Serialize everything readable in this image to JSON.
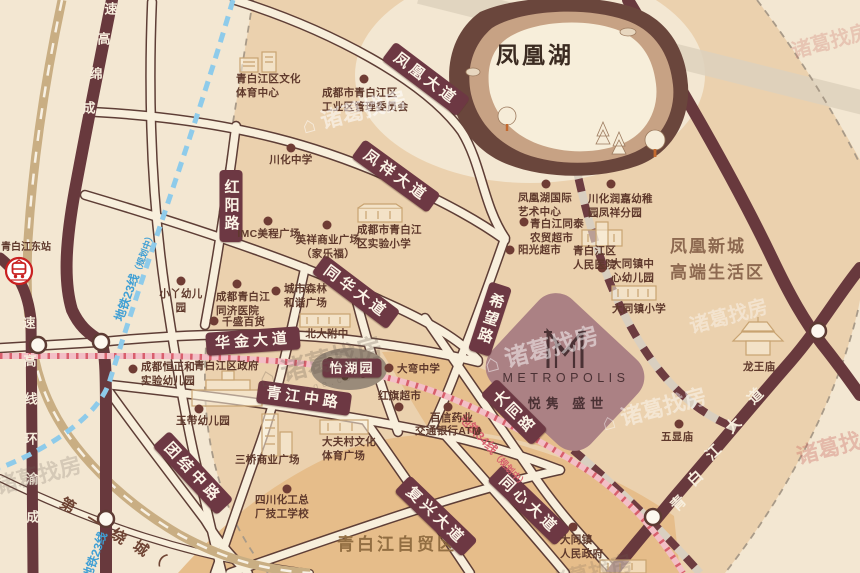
{
  "lake": {
    "label": "凤凰湖"
  },
  "areas": {
    "new_town": "凤凰新城\n高端生活区",
    "free_trade_zone": "青白江自贸区"
  },
  "station": {
    "label": "青白江东站"
  },
  "metropolis": {
    "name_en": "METROPOLIS",
    "name_cn": "悦隽 盛世"
  },
  "roads": {
    "pills": [
      {
        "label": "凤凰大道"
      },
      {
        "label": "凤祥大道"
      },
      {
        "label": "同华大道"
      },
      {
        "label": "红阳路"
      },
      {
        "label": "华金大道"
      },
      {
        "label": "青江中路"
      },
      {
        "label": "团结中路"
      },
      {
        "label": "希望路"
      },
      {
        "label": "大同路"
      },
      {
        "label": "复兴大道"
      },
      {
        "label": "同心大道"
      }
    ],
    "park_pill": "怡湖园",
    "chengmian": {
      "name": "成绵高速",
      "chars": [
        "速",
        "高",
        "绵",
        "成"
      ]
    },
    "chengyu": {
      "name": "成渝环线高速",
      "chars": [
        "速",
        "高",
        "线",
        "环",
        "渝",
        "成"
      ]
    },
    "qbj_avenue": {
      "name": "青白江大道",
      "chars": [
        "青",
        "白",
        "江",
        "大",
        "道"
      ]
    },
    "ring_road": {
      "name": "第一绕城",
      "chars": [
        "第",
        "一",
        "绕",
        "城",
        "（"
      ]
    }
  },
  "metro": {
    "line23": {
      "name": "地铁23线",
      "status": "（规划中）"
    },
    "line34": {
      "name": "地铁34线",
      "status": "（规划中）"
    }
  },
  "pois": [
    {
      "label": "青白江区文化\n体育中心"
    },
    {
      "label": "成都市青白江区\n工业区管理委员会"
    },
    {
      "label": "川化中学"
    },
    {
      "label": "IMC美程广场"
    },
    {
      "label": "英祥商业广场\n（家乐福）"
    },
    {
      "label": "成都市青白江\n区实验小学"
    },
    {
      "label": "凤凰湖国际\n艺术中心"
    },
    {
      "label": "川化润嘉幼稚\n园凤祥分园"
    },
    {
      "label": "青白江同泰\n农贸超市"
    },
    {
      "label": "阳光超市"
    },
    {
      "label": "青白江区\n人民医院"
    },
    {
      "label": "大同镇中\n心幼儿园"
    },
    {
      "label": "大同镇小学"
    },
    {
      "label": "小丫幼儿园"
    },
    {
      "label": "成都青白江\n同济医院"
    },
    {
      "label": "城市森林\n和谐广场"
    },
    {
      "label": "千盛百货"
    },
    {
      "label": "北大附中"
    },
    {
      "label": "成都恒正和\n实验幼儿园"
    },
    {
      "label": "青白江区政府"
    },
    {
      "label": "大弯中学"
    },
    {
      "label": "红旗超市"
    },
    {
      "label": "百信药业"
    },
    {
      "label": "交通银行ATM"
    },
    {
      "label": "大夫村文化\n体育广场"
    },
    {
      "label": "三桥商业广场"
    },
    {
      "label": "玉带幼儿园"
    },
    {
      "label": "四川化工总\n厂技工学校"
    },
    {
      "label": "大同镇\n人民政府"
    },
    {
      "label": "五显庙"
    },
    {
      "label": "龙王庙"
    }
  ],
  "watermark": {
    "icon": "⌂",
    "text": "诸葛找房",
    "domain": "zhuge.com"
  }
}
